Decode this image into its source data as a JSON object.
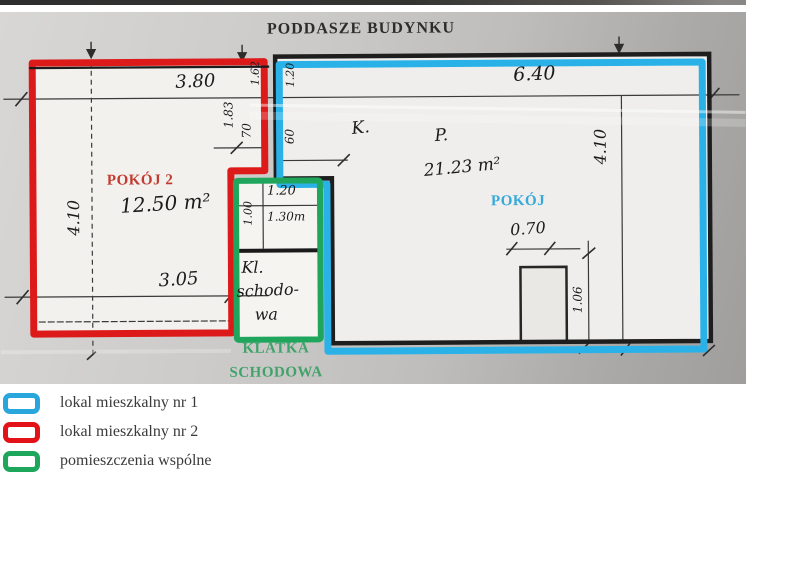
{
  "title": "PODDASZE BUDYNKU",
  "plan": {
    "unit1": {
      "room_label": "POKÓJ",
      "room_mark": "P.",
      "room_area": "21.23 m²"
    },
    "unit2": {
      "room_label": "POKÓJ 2",
      "room_mark": "K.",
      "room_area": "12.50 m²"
    },
    "common": {
      "label_line1": "KLATKA",
      "label_line2": "SCHODOWA",
      "hand_line1": "Kl.",
      "hand_line2": "schodo-",
      "hand_line3": "wa"
    },
    "dims": {
      "top_left_width": "3.80",
      "top_right_width": "6.40",
      "left_height": "4.10",
      "right_height": "4.10",
      "room2_bottom_width": "3.05",
      "door_width": "0.70",
      "door_depth": "1.06",
      "notch_left_upper": "1.62",
      "notch_right_upper": "1.20",
      "notch_left_mid": "1.83",
      "notch_left_lower": "70",
      "notch_right_lower": "60",
      "stair_top_width": "1.20",
      "stair_left_height": "1.00",
      "stair_inner_width": "1.30m"
    }
  },
  "colors": {
    "unit1_blue": "#2ab2e8",
    "unit2_red": "#dd1a1a",
    "common_green": "#1fa65c",
    "wall_black": "#1e1e1e"
  },
  "legend": {
    "items": [
      {
        "label": "lokal mieszkalny nr 1"
      },
      {
        "label": "lokal mieszkalny nr 2"
      },
      {
        "label": "pomieszczenia wspólne"
      }
    ]
  }
}
